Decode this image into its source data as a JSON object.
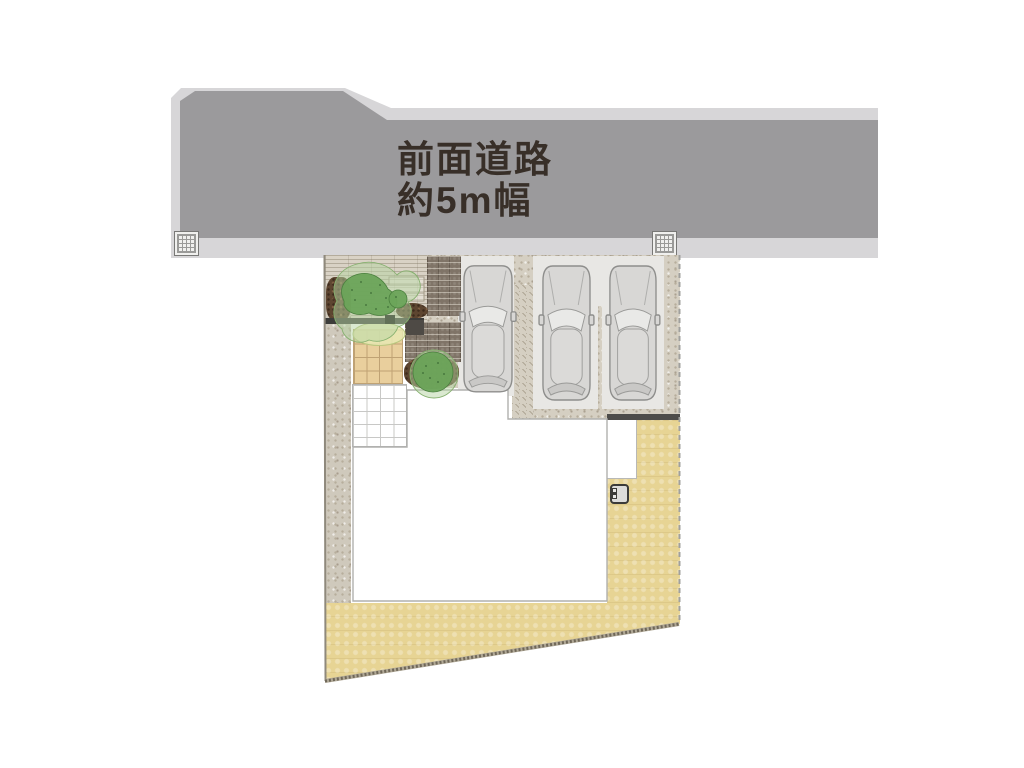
{
  "road": {
    "label_line1": "前面道路",
    "label_line2": "約5m幅"
  },
  "site": {
    "car_count": 3,
    "tree_count": 2,
    "drain_grate_count": 2
  },
  "colors": {
    "road_surface": "#9b9a9c",
    "sidewalk": "#d7d6d8",
    "label_text": "#382f28",
    "grate_line": "#9a9a98",
    "sand": "#e7d494",
    "speckle": "#d5cfc2",
    "speckle_dot": "#b7ae9c",
    "walkway": "#cfc9bc",
    "stone": "#d9d2c5",
    "brick": "#7f7467",
    "mulch": "#5d4530",
    "tree_dark": "#6ca45a",
    "tree_light": "#b5d3a2",
    "groundcover": "#e7e9b4",
    "house_fill": "#ffffff",
    "house_outline": "#b0b0ae",
    "pad": "#e8e7e4",
    "dark_band": "#4d4c4a",
    "tile": "#e9cf9d",
    "tile_line": "#bfa274",
    "grid_line": "#c8c8c6",
    "car_body": "#d8d7d5",
    "car_line": "#8e8e8c"
  }
}
